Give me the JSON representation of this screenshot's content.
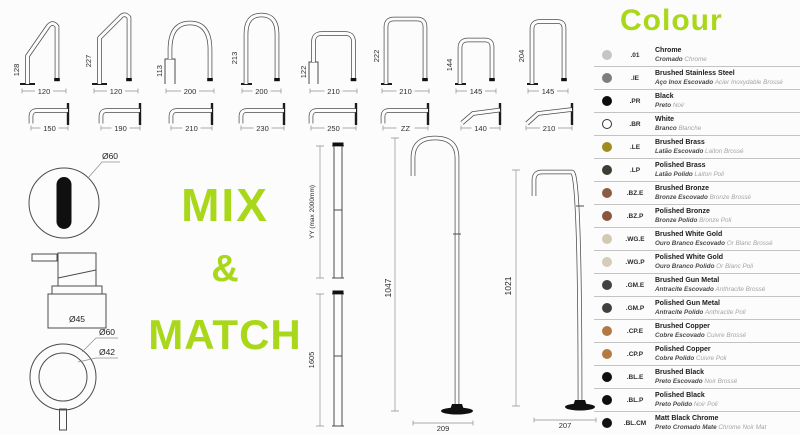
{
  "accent": "#a9d71a",
  "mix_match": [
    "MIX",
    "&",
    "MATCH"
  ],
  "top_spouts": [
    {
      "height": "128",
      "width": "120"
    },
    {
      "height": "227",
      "width": "120"
    },
    {
      "height": "113",
      "width": "200"
    },
    {
      "height": "213",
      "width": "200"
    },
    {
      "height": "122",
      "width": "210"
    },
    {
      "height": "222",
      "width": "210"
    },
    {
      "height": "144",
      "width": "145"
    },
    {
      "height": "204",
      "width": "145"
    }
  ],
  "wall_spouts": [
    {
      "width": "150"
    },
    {
      "width": "190"
    },
    {
      "width": "210"
    },
    {
      "width": "230"
    },
    {
      "width": "250"
    },
    {
      "width": "ZZ"
    },
    {
      "width": "140"
    },
    {
      "width": "210"
    }
  ],
  "details": {
    "face": "Ø60",
    "dispenser": "Ø45",
    "handle_outer": "Ø60",
    "handle_inner": "Ø42"
  },
  "pipes": {
    "custom_label": "YY (max 2000mm)",
    "straight": "1605"
  },
  "floor_spouts": {
    "round": {
      "height": "1047",
      "base": "209"
    },
    "square": {
      "height": "1021",
      "base": "207"
    }
  },
  "colour": {
    "title": "Colour",
    "items": [
      {
        "code": ".01",
        "name": "Chrome",
        "pt": "Cromado",
        "fr": "Chrome",
        "swatch": "#c5c5c5"
      },
      {
        "code": ".IE",
        "name": "Brushed Stainless Steel",
        "pt": "Aço Inox Escovado",
        "fr": "Acier Inoxydable Brossé",
        "swatch": "#7e7e7e"
      },
      {
        "code": ".PR",
        "name": "Black",
        "pt": "Preto",
        "fr": "Noir",
        "swatch": "#0d0d0d"
      },
      {
        "code": ".BR",
        "name": "White",
        "pt": "Branco",
        "fr": "Blanche",
        "swatch": "#ffffff",
        "outline": true
      },
      {
        "code": ".LE",
        "name": "Brushed Brass",
        "pt": "Latão Escovado",
        "fr": "Laiton Brossé",
        "swatch": "#a18c1f"
      },
      {
        "code": ".LP",
        "name": "Polished Brass",
        "pt": "Latão Polido",
        "fr": "Laiton Poli",
        "swatch": "#3e3c33"
      },
      {
        "code": ".BZ.E",
        "name": "Brushed Bronze",
        "pt": "Bronze Escovado",
        "fr": "Bronze Brossé",
        "swatch": "#8b5c41"
      },
      {
        "code": ".BZ.P",
        "name": "Polished Bronze",
        "pt": "Bronze Polido",
        "fr": "Bronze Poli",
        "swatch": "#8a573d"
      },
      {
        "code": ".WG.E",
        "name": "Brushed White Gold",
        "pt": "Ouro Branco Escovado",
        "fr": "Or Blanc Brossé",
        "swatch": "#d2c9b2"
      },
      {
        "code": ".WG.P",
        "name": "Polished White Gold",
        "pt": "Ouro Branco Polido",
        "fr": "Or Blanc Poli",
        "swatch": "#d5ccba"
      },
      {
        "code": ".GM.E",
        "name": "Brushed Gun Metal",
        "pt": "Antracite Escovado",
        "fr": "Anthracite Brossé",
        "swatch": "#42413d"
      },
      {
        "code": ".GM.P",
        "name": "Polished Gun Metal",
        "pt": "Antracite Polido",
        "fr": "Anthracite Poli",
        "swatch": "#41403c"
      },
      {
        "code": ".CP.E",
        "name": "Brushed Copper",
        "pt": "Cobre Escovado",
        "fr": "Cuivre Brossé",
        "swatch": "#b27947"
      },
      {
        "code": ".CP.P",
        "name": "Polished Copper",
        "pt": "Cobre Polido",
        "fr": "Cuivre Poli",
        "swatch": "#b47a41"
      },
      {
        "code": ".BL.E",
        "name": "Brushed Black",
        "pt": "Preto Escovado",
        "fr": "Noir Brossé",
        "swatch": "#101010"
      },
      {
        "code": ".BL.P",
        "name": "Polished Black",
        "pt": "Preto Polido",
        "fr": "Noir Poli",
        "swatch": "#0e0e0e"
      },
      {
        "code": ".BL.CM",
        "name": "Matt Black Chrome",
        "pt": "Preto Cromado Mate",
        "fr": "Chrome Noir Mat",
        "swatch": "#111111"
      }
    ]
  }
}
